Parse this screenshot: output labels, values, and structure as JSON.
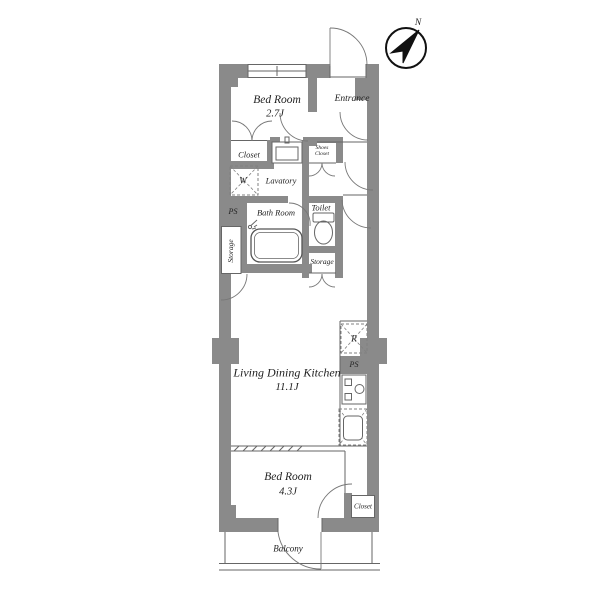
{
  "plan": {
    "kind": "apartment-floor-plan",
    "colors": {
      "wall": "#8a8a8a",
      "thin_line": "#666666",
      "door_arc": "#777777",
      "dashed": "#808080",
      "text": "#222222",
      "compass": "#111111",
      "background": "#ffffff"
    },
    "compass": {
      "label": "N"
    },
    "rooms": {
      "bedroom1": {
        "name": "Bed Room",
        "size": "2.7J"
      },
      "entrance": {
        "name": "Entrance"
      },
      "closet1": {
        "name": "Closet"
      },
      "shoes_closet": {
        "line1": "Shoes",
        "line2": "Closet"
      },
      "lavatory": {
        "name": "Lavatory"
      },
      "bathroom": {
        "name": "Bath Room"
      },
      "toilet": {
        "name": "Toilet"
      },
      "storage_left": {
        "name": "Storage"
      },
      "storage_hall": {
        "name": "Storage"
      },
      "ldk": {
        "name": "Living Dining Kitchen",
        "size": "11.1J"
      },
      "bedroom2": {
        "name": "Bed Room",
        "size": "4.3J"
      },
      "closet2": {
        "name": "Closet"
      },
      "balcony": {
        "name": "Balcony"
      }
    },
    "marks": {
      "washer": "W",
      "fridge": "R",
      "pipe_space_left": "PS",
      "pipe_space_right": "PS"
    }
  }
}
